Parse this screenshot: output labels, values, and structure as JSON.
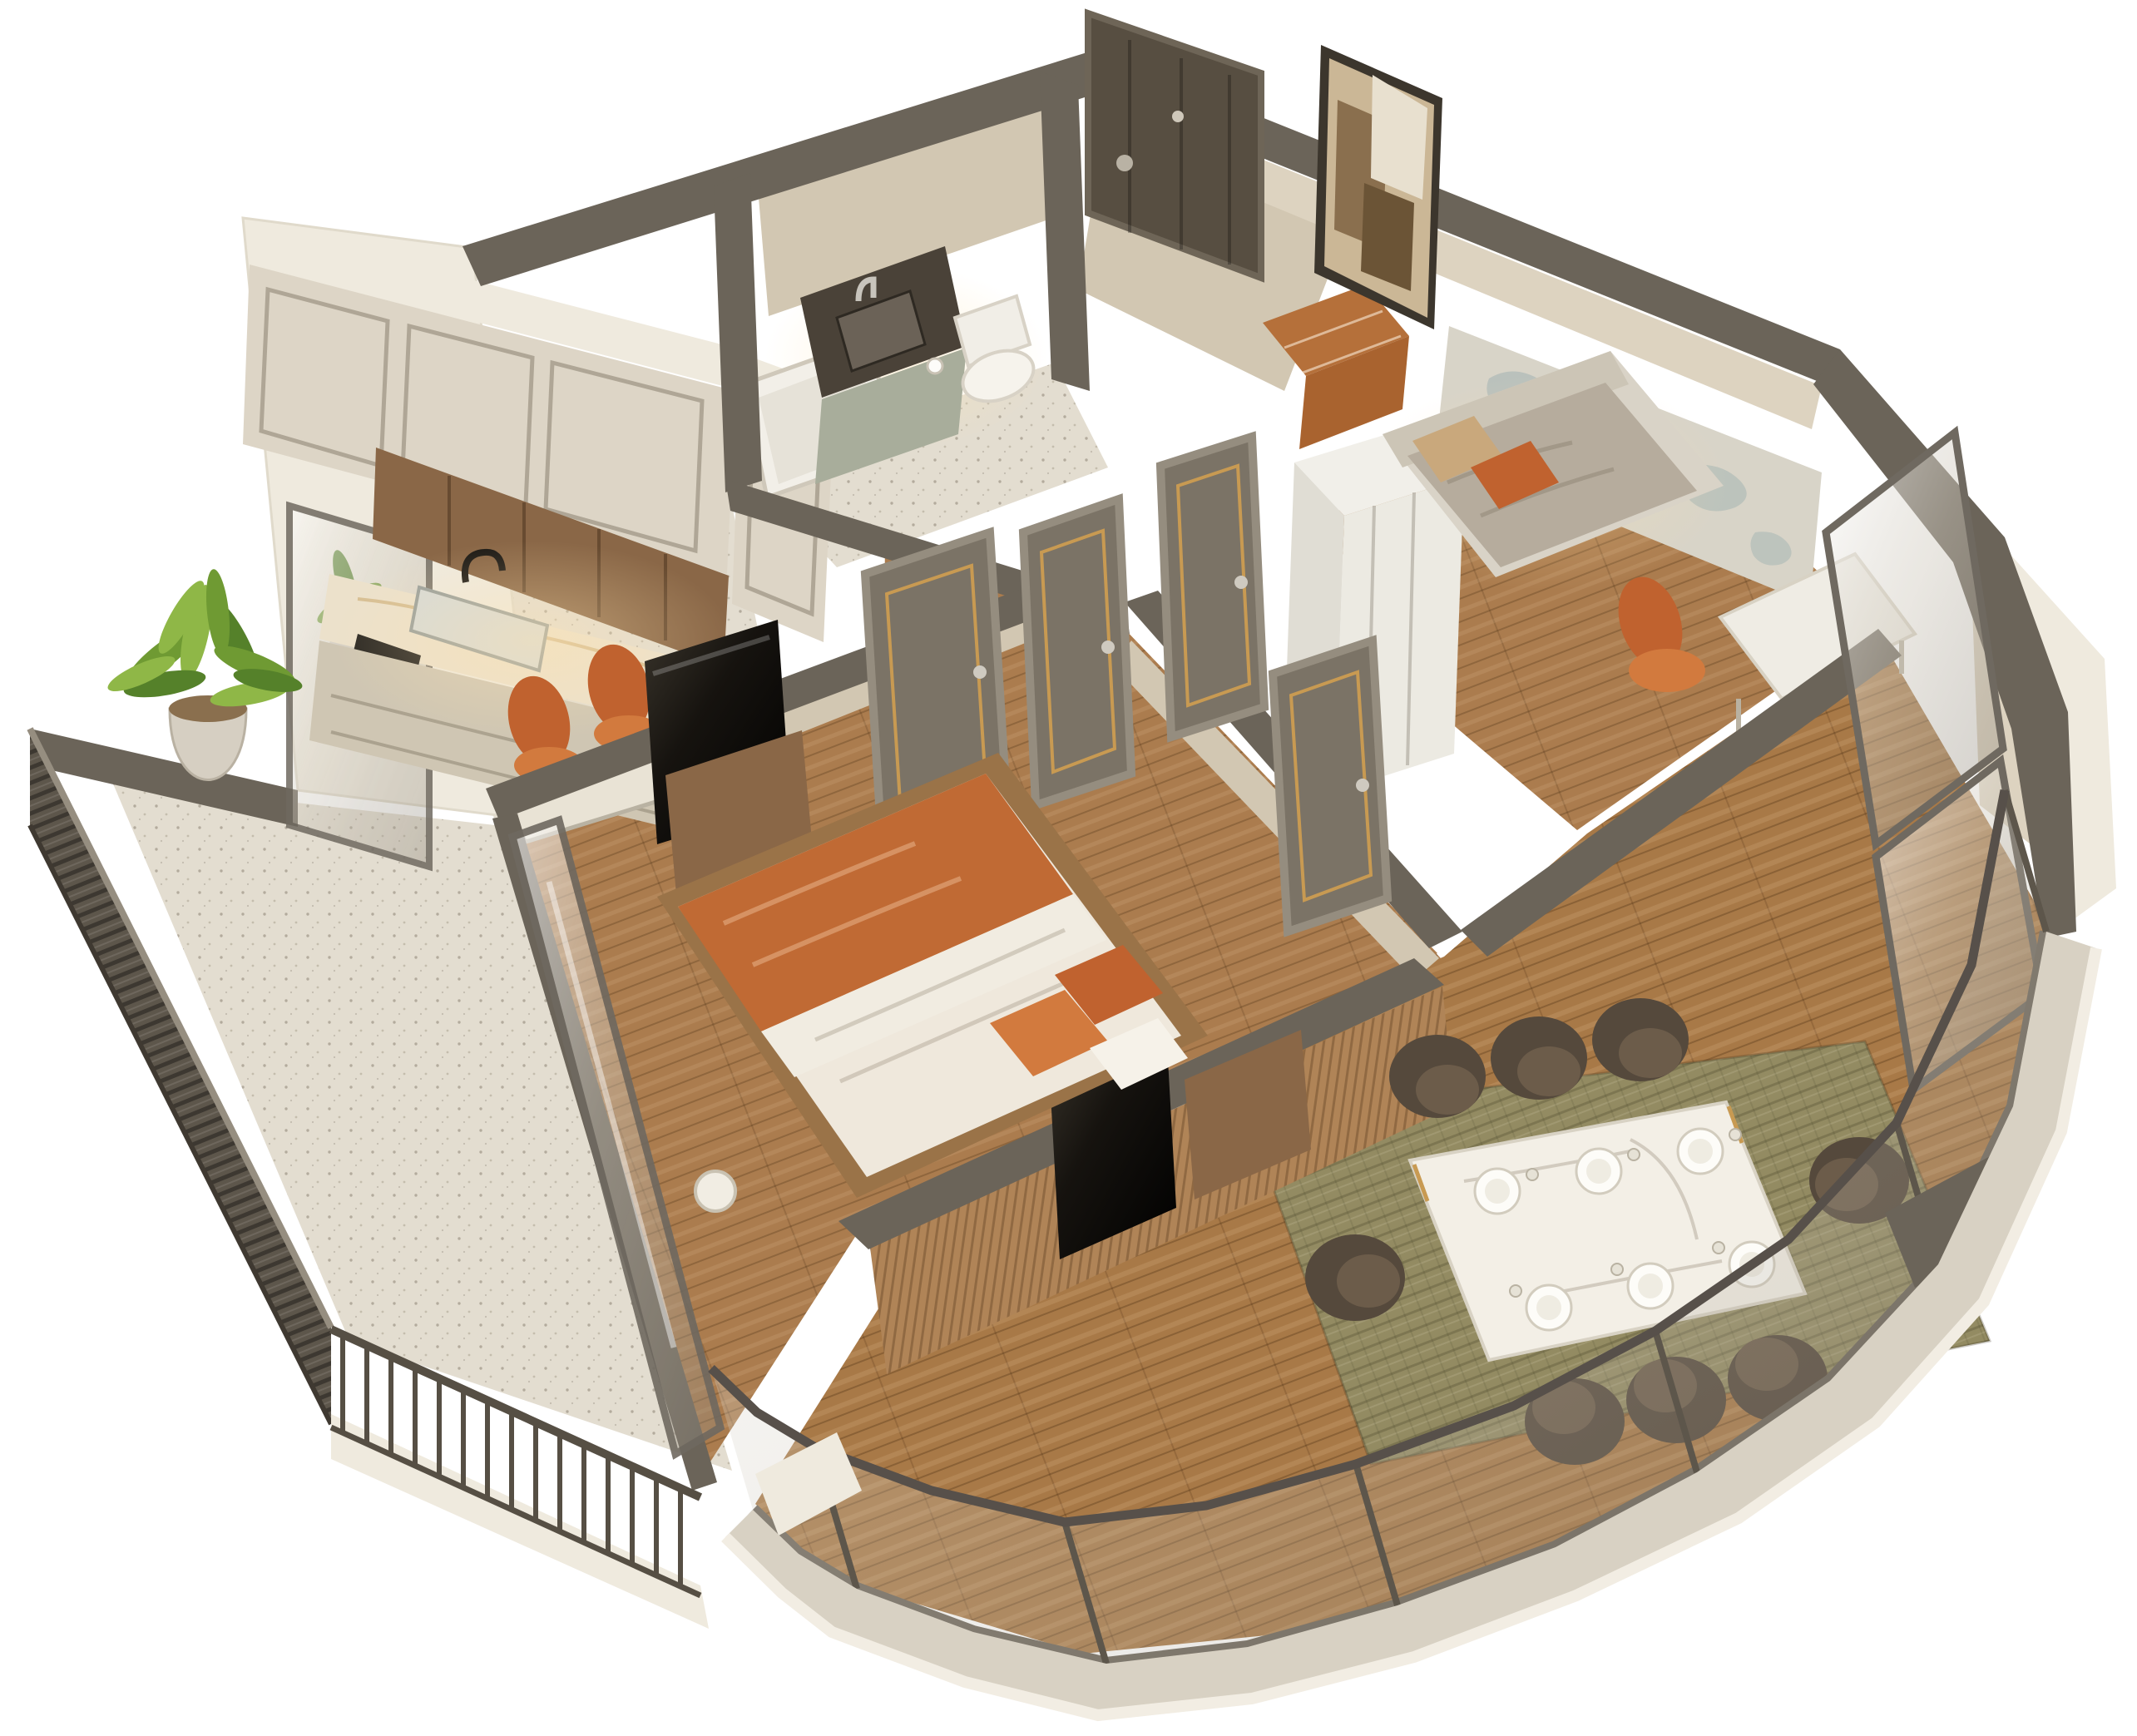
{
  "scene": {
    "description": "3D isometric cutaway floor plan render of a one-bedroom-plus-study apartment with kitchen, bathroom, hallway, master bedroom, second bedroom with world-map wall, dining-living room with curved glass facade, and two balconies",
    "style": "photoreal 3D top-down perspective render on white background"
  },
  "palette": {
    "wallTop": "#6b6459",
    "wallTop2": "#5a534a",
    "wallFace": "#ddd3c0",
    "wallFace2": "#d2c7b2",
    "outer": "#efeade",
    "outerBand": "#d8d1c3",
    "cab": "#ddd5c6",
    "cab2": "#cfc6b3",
    "kitWood": "#8a6747",
    "marble": "#ece1cb",
    "wood1": "#ab7c4e",
    "wood2": "#a87947",
    "terrazzo": "#e3ddd0",
    "slatWood": "#b08457",
    "louver": "#5d564b",
    "rug": "#938b62",
    "door": "#7b7366",
    "doorFrame": "#958d7f",
    "gold": "#c89a52",
    "orange": "#c0622f",
    "orange2": "#d27a3e",
    "chair": "#55493c",
    "chairLight": "#6c5c4a",
    "mapBase": "#d8d4c8",
    "mapLand": "#b7bfba",
    "plantA": "#6f9a33",
    "plantB": "#8fb747",
    "plantC": "#55812a",
    "leather": "#a9632f",
    "leather2": "#b5703a",
    "tv": "#16130f",
    "white": "#f4f0e7",
    "glassFrame": "#6f6960"
  },
  "rooms": [
    {
      "name": "kitchen"
    },
    {
      "name": "bathroom"
    },
    {
      "name": "entry-hall"
    },
    {
      "name": "hallway"
    },
    {
      "name": "master-bedroom"
    },
    {
      "name": "second-bedroom"
    },
    {
      "name": "living-dining-room"
    },
    {
      "name": "side-balcony"
    },
    {
      "name": "curved-balcony-facade"
    }
  ],
  "furniture_counts": {
    "interior_doors": 4,
    "entrance_doors": 1,
    "dining_chairs": 8,
    "place_settings": 6,
    "beds": 2,
    "tvs": 2,
    "potted_plants": 2,
    "orange_stools": 2,
    "wall_art": 1
  }
}
